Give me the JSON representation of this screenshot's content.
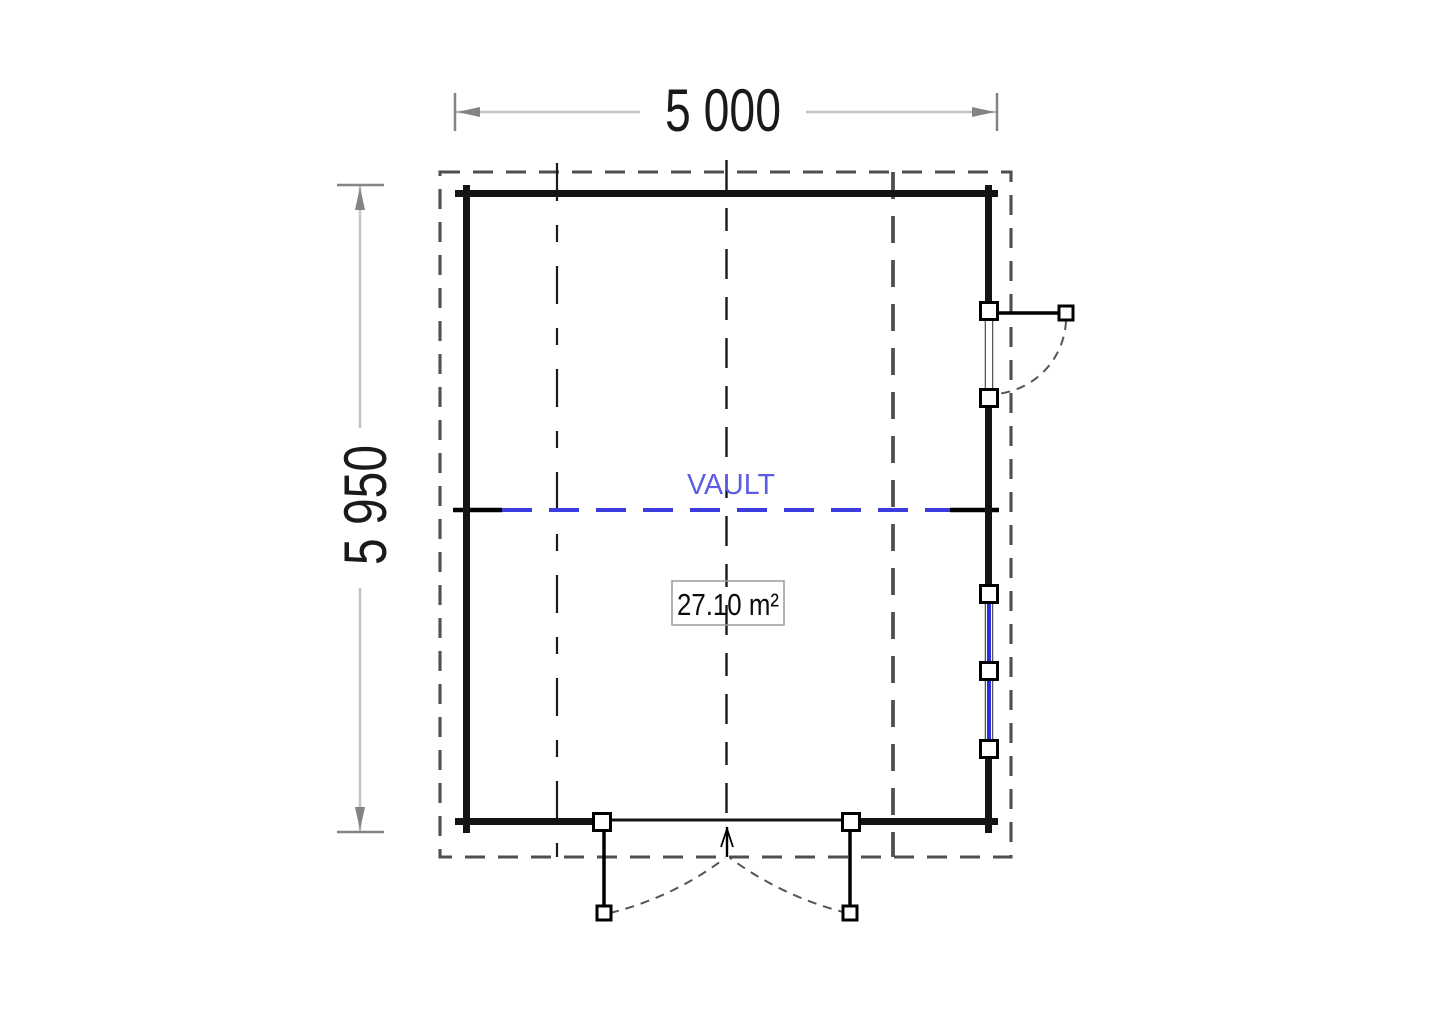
{
  "drawing": {
    "dimensions": {
      "width_label": "5 000",
      "height_label": "5 950"
    },
    "labels": {
      "vault": "VAULT",
      "area": "27.10 m²"
    },
    "colors": {
      "background": "#ffffff",
      "wall": "#141414",
      "vault_line": "#3b3be0",
      "vault_text": "#5d5de4",
      "window_glass": "#2d2de0",
      "dimension_line": "#c4c4c4",
      "dimension_tick": "#848484",
      "dimension_text": "#1a1a1a",
      "overhang_dash": "#4f4f4f",
      "swing_arc": "#555555",
      "area_box_border": "#9a9a9a"
    }
  }
}
